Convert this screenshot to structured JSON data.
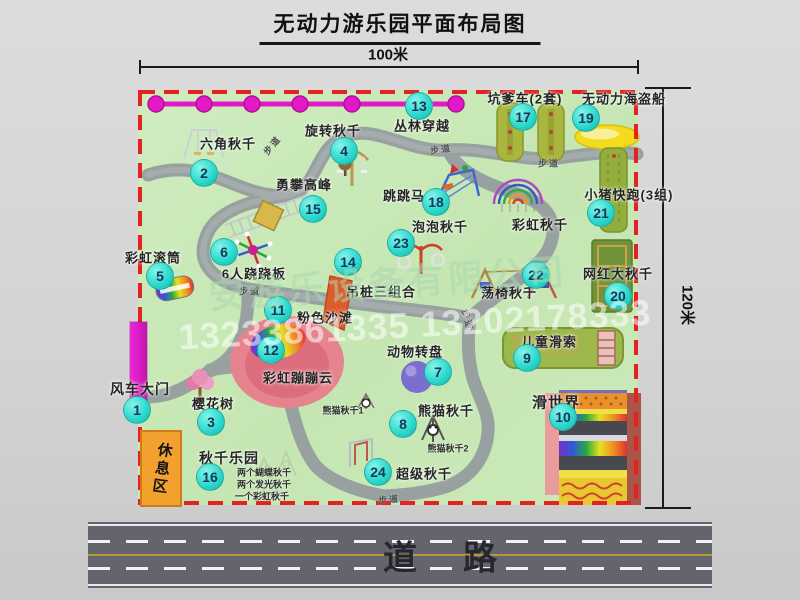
{
  "title": "无动力游乐园平面布局图",
  "dimensions": {
    "top": "100米",
    "right": "120米"
  },
  "road": {
    "label": "道路"
  },
  "rest_area": {
    "label": "休息区"
  },
  "watermark": {
    "company": "安游乐设备有限公司",
    "phone": "13233861335 13202178333"
  },
  "colors": {
    "map_green": "#c8e7b6",
    "border_red": "#e32222",
    "path_gray": "#9aa1a1",
    "badge_teal": "#2fd9cd",
    "zipline_magenta": "#e318c6",
    "gate_magenta": "#e41ec8",
    "rest_orange": "#f2a02e",
    "road_gray": "#64646c"
  },
  "attractions": [
    {
      "num": 1,
      "label": "风车大门",
      "bx": 137,
      "by": 410,
      "lx": 140,
      "ly": 389,
      "size": 14
    },
    {
      "num": 2,
      "label": "六角秋千",
      "bx": 204,
      "by": 173,
      "lx": 228,
      "ly": 143
    },
    {
      "num": 3,
      "label": "樱花树",
      "bx": 211,
      "by": 422,
      "lx": 213,
      "ly": 403
    },
    {
      "num": 4,
      "label": "旋转秋千",
      "bx": 344,
      "by": 151,
      "lx": 333,
      "ly": 130
    },
    {
      "num": 5,
      "label": "彩虹滚筒",
      "bx": 160,
      "by": 276,
      "lx": 153,
      "ly": 257
    },
    {
      "num": 6,
      "label": "6人跷跷板",
      "bx": 224,
      "by": 252,
      "lx": 254,
      "ly": 273
    },
    {
      "num": 7,
      "label": "动物转盘",
      "bx": 438,
      "by": 372,
      "lx": 415,
      "ly": 351
    },
    {
      "num": 8,
      "label": "熊猫秋千",
      "bx": 403,
      "by": 424,
      "lx": 446,
      "ly": 410
    },
    {
      "num": 9,
      "label": "儿童滑索",
      "bx": 527,
      "by": 358,
      "lx": 549,
      "ly": 341
    },
    {
      "num": 10,
      "label": "滑世界",
      "bx": 563,
      "by": 417,
      "lx": 556,
      "ly": 402,
      "size": 15
    },
    {
      "num": 11,
      "label": "粉色沙滩",
      "bx": 278,
      "by": 310,
      "lx": 325,
      "ly": 317
    },
    {
      "num": 12,
      "label": "彩虹蹦蹦云",
      "bx": 271,
      "by": 350,
      "lx": 298,
      "ly": 377
    },
    {
      "num": 13,
      "label": "丛林穿越",
      "bx": 419,
      "by": 106,
      "lx": 422,
      "ly": 125
    },
    {
      "num": 14,
      "label": "吊桩三组合",
      "bx": 348,
      "by": 262,
      "lx": 381,
      "ly": 291
    },
    {
      "num": 15,
      "label": "勇攀高峰",
      "bx": 313,
      "by": 209,
      "lx": 304,
      "ly": 184
    },
    {
      "num": 16,
      "label": "秋千乐园",
      "bx": 210,
      "by": 477,
      "lx": 229,
      "ly": 458,
      "size": 14
    },
    {
      "num": 17,
      "label": "坑爹车(2套)",
      "bx": 523,
      "by": 117,
      "lx": 525,
      "ly": 98
    },
    {
      "num": 18,
      "label": "跳跳马",
      "bx": 436,
      "by": 202,
      "lx": 404,
      "ly": 195
    },
    {
      "num": 19,
      "label": "无动力海盗船",
      "bx": 586,
      "by": 118,
      "lx": 624,
      "ly": 98
    },
    {
      "num": 20,
      "label": "网红大秋千",
      "bx": 618,
      "by": 296,
      "lx": 618,
      "ly": 273
    },
    {
      "num": 21,
      "label": "小猪快跑(3组)",
      "bx": 601,
      "by": 213,
      "lx": 629,
      "ly": 194
    },
    {
      "num": 22,
      "label": "荡椅秋千",
      "bx": 536,
      "by": 275,
      "lx": 509,
      "ly": 292
    },
    {
      "num": 23,
      "label": "泡泡秋千",
      "bx": 401,
      "by": 243,
      "lx": 440,
      "ly": 226
    },
    {
      "num": 24,
      "label": "超级秋千",
      "bx": 378,
      "by": 472,
      "lx": 424,
      "ly": 473
    },
    {
      "num": null,
      "label": "彩虹秋千",
      "bx": 0,
      "by": 0,
      "lx": 540,
      "ly": 224
    }
  ],
  "sub_labels": [
    {
      "text": "熊猫秋千1",
      "x": 343,
      "y": 410
    },
    {
      "text": "熊猫秋千2",
      "x": 448,
      "y": 448
    },
    {
      "text": "两个蝴蝶秋千",
      "x": 264,
      "y": 472
    },
    {
      "text": "两个发光秋千",
      "x": 264,
      "y": 484
    },
    {
      "text": "一个彩虹秋千",
      "x": 262,
      "y": 496
    }
  ],
  "path_labels": [
    {
      "text": "步道",
      "x": 272,
      "y": 145,
      "rot": -50
    },
    {
      "text": "步道",
      "x": 441,
      "y": 149,
      "rot": -8
    },
    {
      "text": "步道",
      "x": 549,
      "y": 163,
      "rot": 0
    },
    {
      "text": "步道",
      "x": 250,
      "y": 291,
      "rot": 0
    },
    {
      "text": "步道",
      "x": 468,
      "y": 320,
      "rot": 75
    },
    {
      "text": "步道",
      "x": 389,
      "y": 499,
      "rot": -5
    }
  ]
}
